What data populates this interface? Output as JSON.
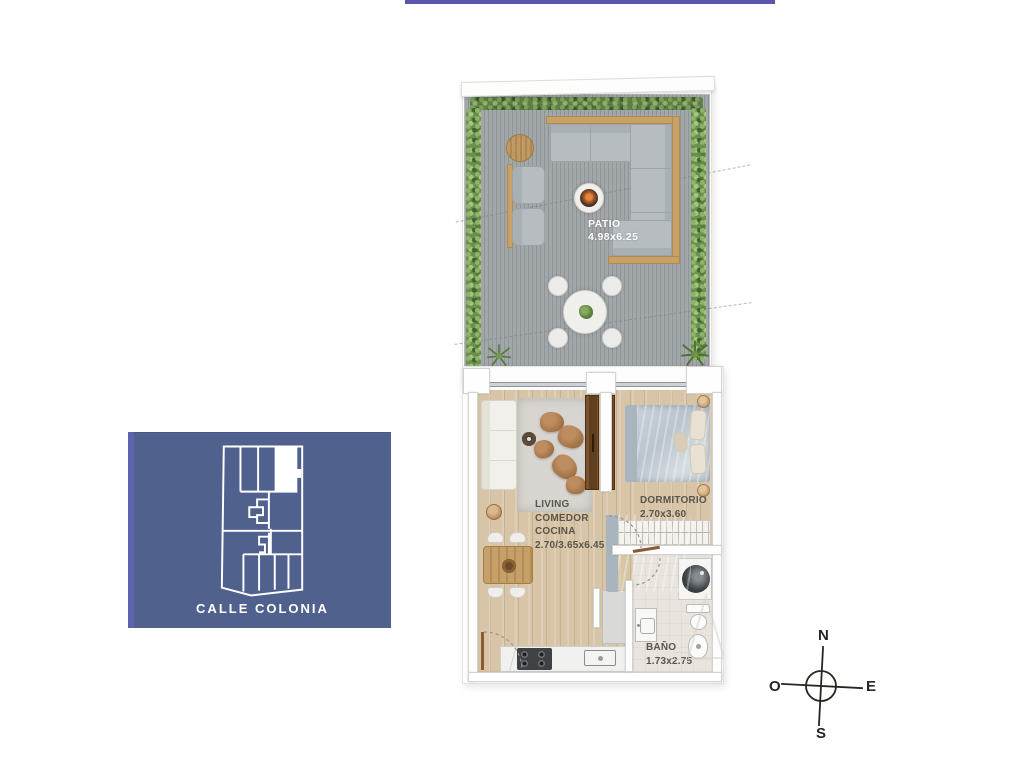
{
  "page": {
    "background": "#ffffff",
    "top_accent_color": "#5b55ae"
  },
  "floor_plan": {
    "patio": {
      "label": "PATIO",
      "dims": "4.98x6.25"
    },
    "living": {
      "lines": [
        "LIVING",
        "COMEDOR",
        "COCINA",
        "2.70/3.65x6.45"
      ]
    },
    "bedroom": {
      "label": "DORMITORIO",
      "dims": "2.70x3.60"
    },
    "bathroom": {
      "label": "BAÑO",
      "dims": "1.73x2.75"
    }
  },
  "key_map": {
    "street": "CALLE COLONIA",
    "background": "#51618e",
    "outline_color": "#ffffff"
  },
  "compass": {
    "north": "N",
    "south": "S",
    "east": "E",
    "west": "O"
  },
  "palette": {
    "deck_gray": "#9aa0a3",
    "hedge_green": "#6a8f50",
    "wood_floor": "#d8c5a8",
    "wood_trim": "#c8a169",
    "sofa_gray": "#b6bcbf",
    "wall_white": "#fefefe",
    "label_text": "#5a554c",
    "keymap_blue": "#51618e",
    "accent_purple": "#5b55ae"
  }
}
